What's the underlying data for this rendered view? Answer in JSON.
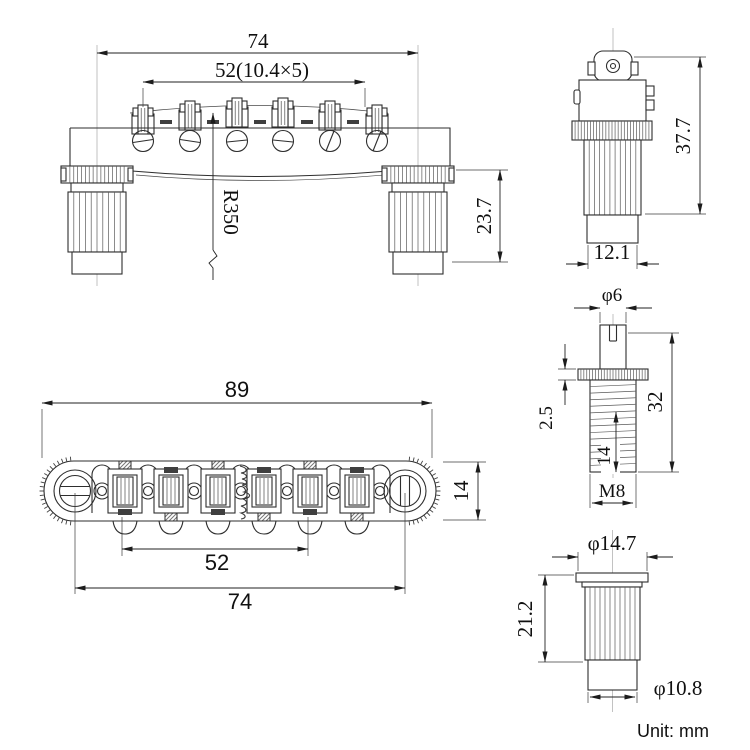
{
  "drawing": {
    "unit_note": "Unit: mm",
    "front": {
      "overall_width": "74",
      "string_spacing": "52(10.4×5)",
      "stud_height": "23.7",
      "saddle_radius": "R350"
    },
    "side": {
      "total_height": "37.7",
      "base_width": "12.1"
    },
    "stud": {
      "head_diameter": "φ6",
      "collar_thickness": "2.5",
      "stud_length": "32",
      "thread_length": "14",
      "thread_size": "M8"
    },
    "top": {
      "overall_length": "89",
      "body_width": "14",
      "saddle_span": "52",
      "post_spacing": "74"
    },
    "bushing": {
      "flange_diameter": "φ14.7",
      "bushing_height": "21.2",
      "body_diameter": "φ10.8"
    }
  }
}
